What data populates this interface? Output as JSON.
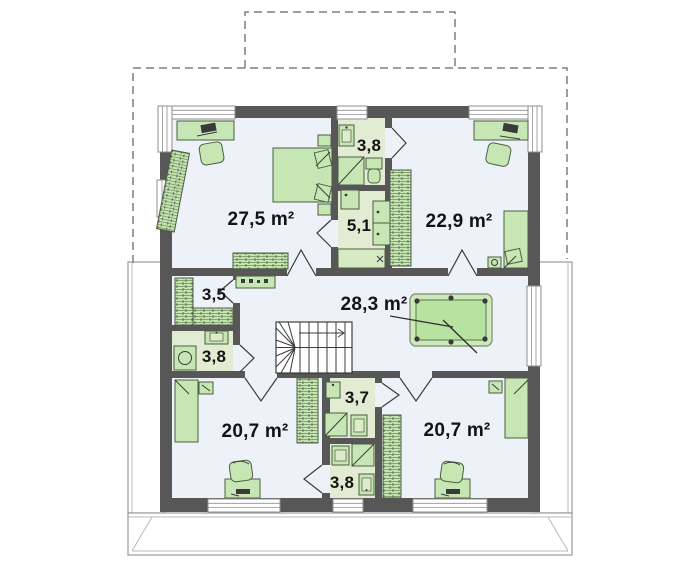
{
  "floor_plan": {
    "type": "architectural-floor-plan",
    "rooms": [
      {
        "name": "bedroom-top-left",
        "area_label": "27,5 m²"
      },
      {
        "name": "bathroom-top",
        "area_label": "3,8"
      },
      {
        "name": "laundry-room",
        "area_label": "5,1"
      },
      {
        "name": "bedroom-top-right",
        "area_label": "22,9 m²"
      },
      {
        "name": "closet",
        "area_label": "3,5"
      },
      {
        "name": "hall-with-stairs",
        "area_label": "28,3 m²"
      },
      {
        "name": "bathroom-left",
        "area_label": "3,8"
      },
      {
        "name": "bathroom-middle",
        "area_label": "3,7"
      },
      {
        "name": "bathroom-bottom",
        "area_label": "3,8"
      },
      {
        "name": "bedroom-bottom-left",
        "area_label": "20,7 m²"
      },
      {
        "name": "bedroom-bottom-right",
        "area_label": "20,7 m²"
      }
    ],
    "colors": {
      "wall": "#575757",
      "room_floor": "#edf1f8",
      "bathroom_floor": "#e1ecd2",
      "furniture_fill": "#c6e7b4",
      "furniture_stroke": "#4d5e42",
      "pool_table_fill": "#b7e3a0",
      "roof_outline_dash": "#7e7e7e",
      "terrace_line": "#9a9a9a",
      "label_text": "#141414"
    },
    "icons": [
      "bed-icon",
      "pillow-icon",
      "nightstand-icon",
      "desk-icon",
      "laptop-icon",
      "chair-icon",
      "wardrobe-icon",
      "sideboard-icon",
      "shelf-icon",
      "stairs-icon",
      "stairs-direction-arrow",
      "pool-table-icon",
      "cue-stick-icon",
      "sink-icon",
      "shower-icon",
      "toilet-icon",
      "washing-machine-icon",
      "counter-icon",
      "window-icon",
      "door-swing-icon",
      "roof-outline",
      "dormer-outline",
      "terrace-outline"
    ]
  }
}
